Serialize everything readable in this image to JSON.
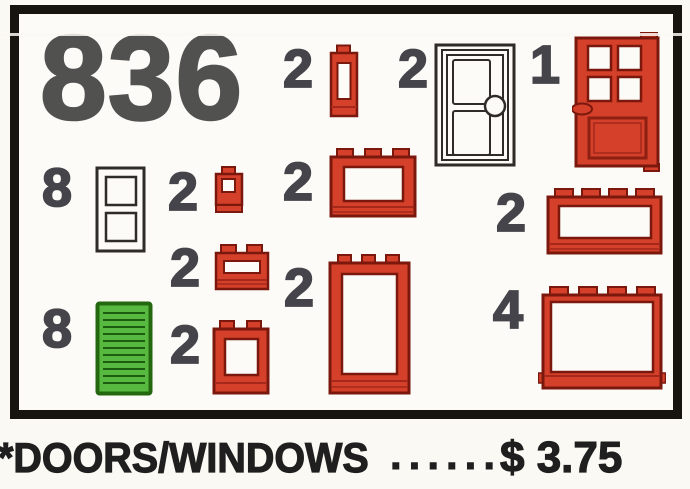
{
  "set": {
    "number": "836"
  },
  "footer": {
    "title": "*DOORS/WINDOWS",
    "dots": "......",
    "price": "$ 3.75"
  },
  "items": [
    {
      "qty": "2",
      "piece": "red window 1x1x2 tall narrow"
    },
    {
      "qty": "2",
      "piece": "white door with round knob"
    },
    {
      "qty": "1",
      "piece": "red door with 4-pane window"
    },
    {
      "qty": "8",
      "piece": "white window 1x2x3 two panes"
    },
    {
      "qty": "2",
      "piece": "red window brick 1x1"
    },
    {
      "qty": "2",
      "piece": "red window 1x3x2"
    },
    {
      "qty": "2",
      "piece": "red window 1x4x2"
    },
    {
      "qty": "2",
      "piece": "red brick with slot 1x2"
    },
    {
      "qty": "2",
      "piece": "red door frame 1x2x3"
    },
    {
      "qty": "4",
      "piece": "red window 1x4x3"
    },
    {
      "qty": "8",
      "piece": "green shutter"
    },
    {
      "qty": "2",
      "piece": "red window 1x2x2"
    }
  ],
  "colors": {
    "red": "#d4402a",
    "red_outline": "#7a180d",
    "green": "#58b941",
    "green_outline": "#23680f",
    "ink": "#45444a",
    "border": "#17130e",
    "paper": "#fbf9f4"
  }
}
